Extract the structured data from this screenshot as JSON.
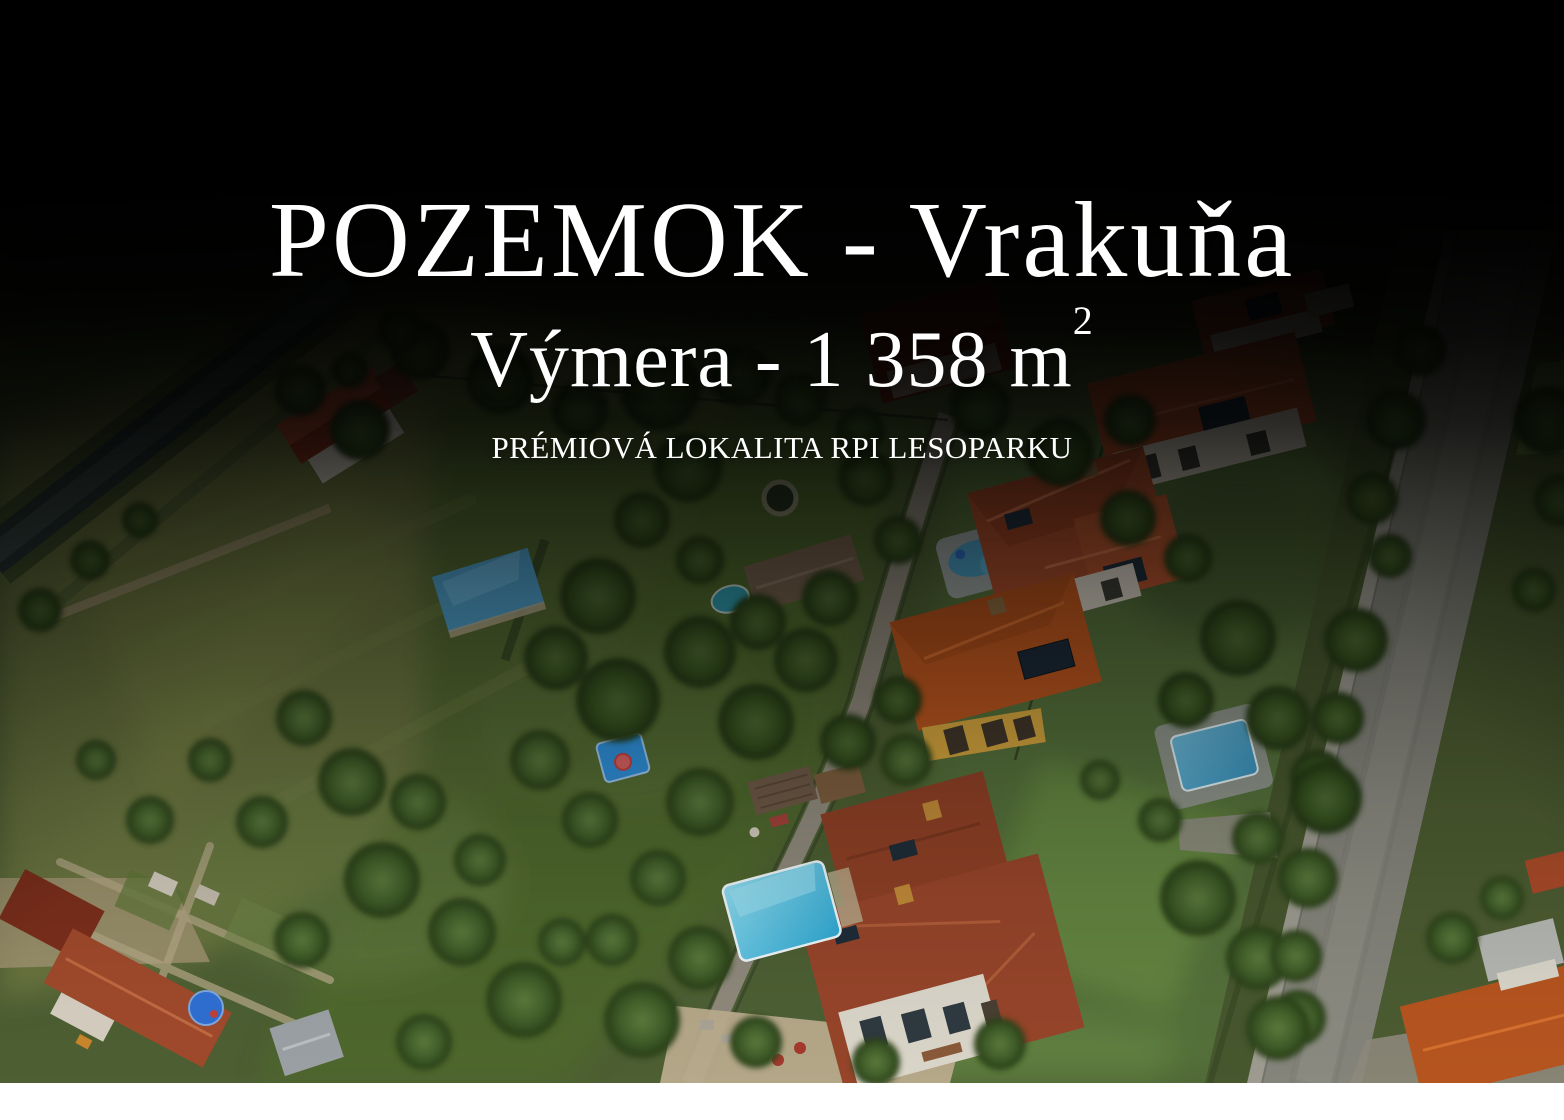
{
  "hero": {
    "title": "POZEMOK - Vrakuňa",
    "area_label": "Výmera - 1 358 m",
    "area_unit_exponent": "2",
    "tagline": "PRÉMIOVÁ LOKALITA RPI LESOPARKU",
    "text_color": "#ffffff"
  }
}
